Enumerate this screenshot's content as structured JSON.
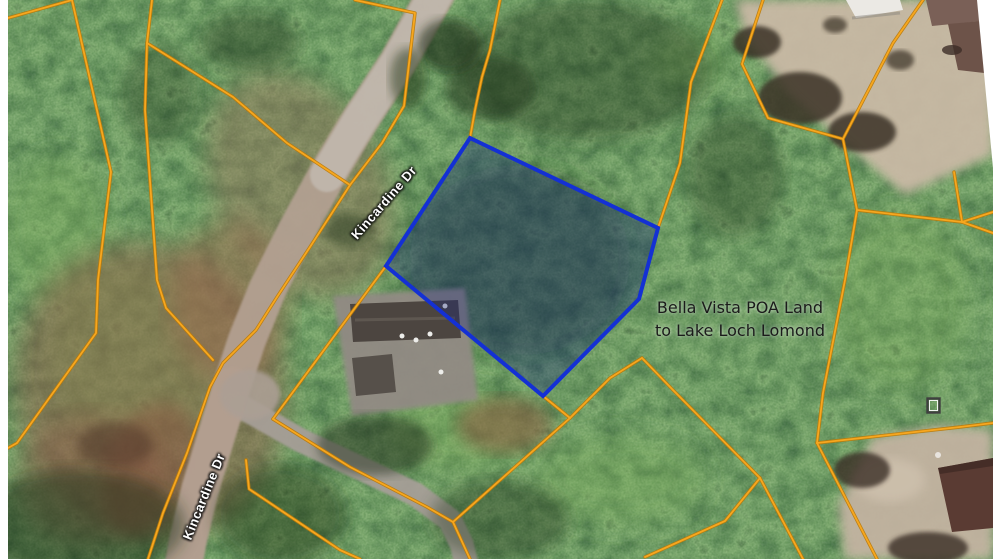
{
  "image_type": "aerial-parcel-map",
  "map": {
    "street_labels": [
      {
        "text": "Kincardine Dr",
        "orientation_deg": -49
      },
      {
        "text": "Kincardine Dr",
        "orientation_deg": -68
      }
    ],
    "annotation": {
      "line1": "Bella Vista POA Land",
      "line2": "to Lake Loch Lomond"
    },
    "subject_parcel": {
      "outline_color": "#1430d4",
      "fill": "rgba(18,34,120,0.33)",
      "vertices": [
        [
          470,
          138
        ],
        [
          658,
          228
        ],
        [
          639,
          299
        ],
        [
          543,
          396
        ],
        [
          386,
          266
        ]
      ]
    },
    "boundary_lines": {
      "core_color": "#f7a71f",
      "casing_color": "#bb7a08"
    },
    "icons": [
      {
        "name": "survey-marker-icon",
        "shape": "hollow-square",
        "position": [
          928,
          399
        ]
      }
    ]
  }
}
